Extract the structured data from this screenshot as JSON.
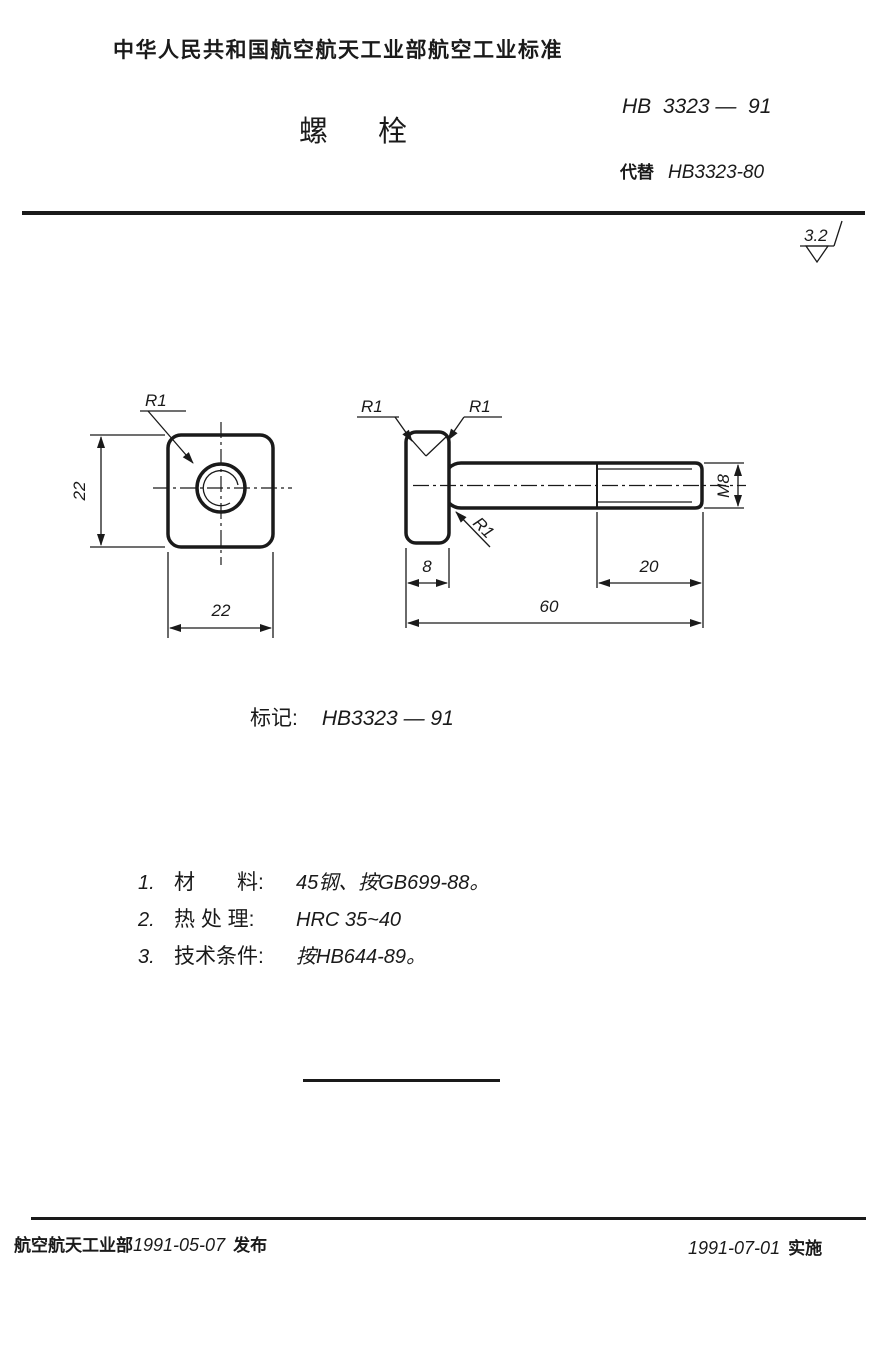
{
  "document": {
    "header": "中华人民共和国航空航天工业部航空工业标准",
    "title": "螺栓",
    "standard_no": "HB  3323 —  91",
    "supersedes_label": "代替",
    "supersedes_no": "HB3323-80"
  },
  "surface_finish": {
    "roughness": "3.2"
  },
  "drawing": {
    "front_view": {
      "corner_radius": "R1",
      "height": "22",
      "width": "22"
    },
    "side_view": {
      "corner_radius_left": "R1",
      "corner_radius_right": "R1",
      "fillet_radius": "R1",
      "head_thickness": "8",
      "thread_length": "20",
      "total_length": "60",
      "thread_spec": "M8"
    }
  },
  "marking": {
    "label": "标记:",
    "value": "HB3323 — 91"
  },
  "notes": [
    {
      "no": "1.",
      "label": "材　　料:",
      "value": "45钢、按GB699-88。"
    },
    {
      "no": "2.",
      "label": "热 处 理:",
      "value": "HRC 35~40"
    },
    {
      "no": "3.",
      "label": "技术条件:",
      "value": "按HB644-89。"
    }
  ],
  "footer": {
    "issuer": "航空航天工业部",
    "issue_date": "1991-05-07",
    "issue_action": "发布",
    "effective_date": "1991-07-01",
    "effective_action": "实施"
  }
}
